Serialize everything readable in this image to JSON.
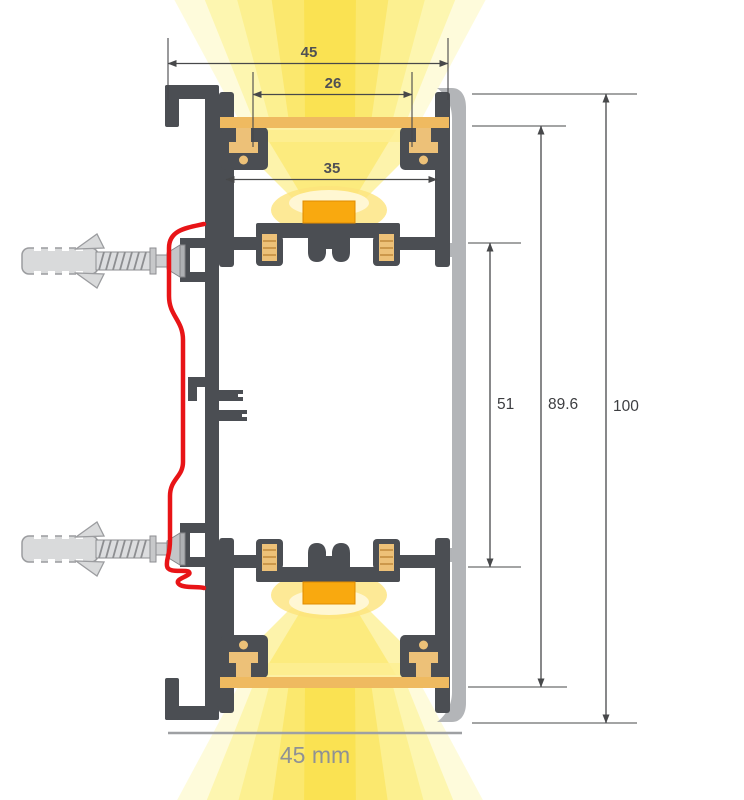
{
  "diagram": {
    "type": "led-wall-profile-cross-section",
    "dims": {
      "outer_width_top": "45",
      "opening_width": "26",
      "chamber_width": "35",
      "led_axis_spacing": "51",
      "inner_height": "89.6",
      "overall_height": "100",
      "overall_width_label": "45 mm"
    },
    "colors": {
      "profile_body": "#4b4e53",
      "cover_shell": "#b3b5b8",
      "led_module": "#f9a90f",
      "diffuser": "#efba60",
      "glow_core": "#fae14f",
      "glow_mid": "#fcef8d",
      "glow_pale": "#fefad2",
      "mount_bracket": "#e81417",
      "hardware": "#d9dadb",
      "dimension_lines": "#47484a",
      "dimension_text": "#4f5054",
      "bottom_label_text": "#8f9194"
    }
  }
}
